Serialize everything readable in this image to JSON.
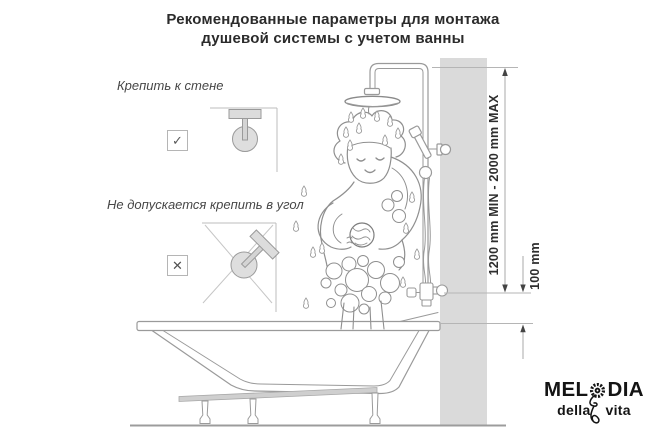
{
  "title": {
    "line1": "Рекомендованные параметры для монтажа",
    "line2": "душевой системы с учетом ванны"
  },
  "instructions": {
    "wall": {
      "label": "Крепить к стене",
      "mark": "✓"
    },
    "corner": {
      "label": "Не допускается крепить в угол",
      "mark": "✕"
    }
  },
  "dimensions": {
    "height_range": "1200 mm MIN - 2000 mm MAX",
    "offset": "100 mm"
  },
  "logo": {
    "brand_prefix": "MEL",
    "brand_suffix": "DIA",
    "tagline_left": "della",
    "tagline_right": "vita"
  },
  "icons": {
    "logo_flower": "sunflower-icon",
    "logo_stem": "flower-stem-icon",
    "allowed": "check-icon",
    "forbidden": "cross-icon"
  },
  "colors": {
    "text": "#2b2b2b",
    "line_art": "#9a9a9a",
    "wall_fill": "#dadada",
    "logo": "#141414",
    "arrow": "#444444"
  }
}
